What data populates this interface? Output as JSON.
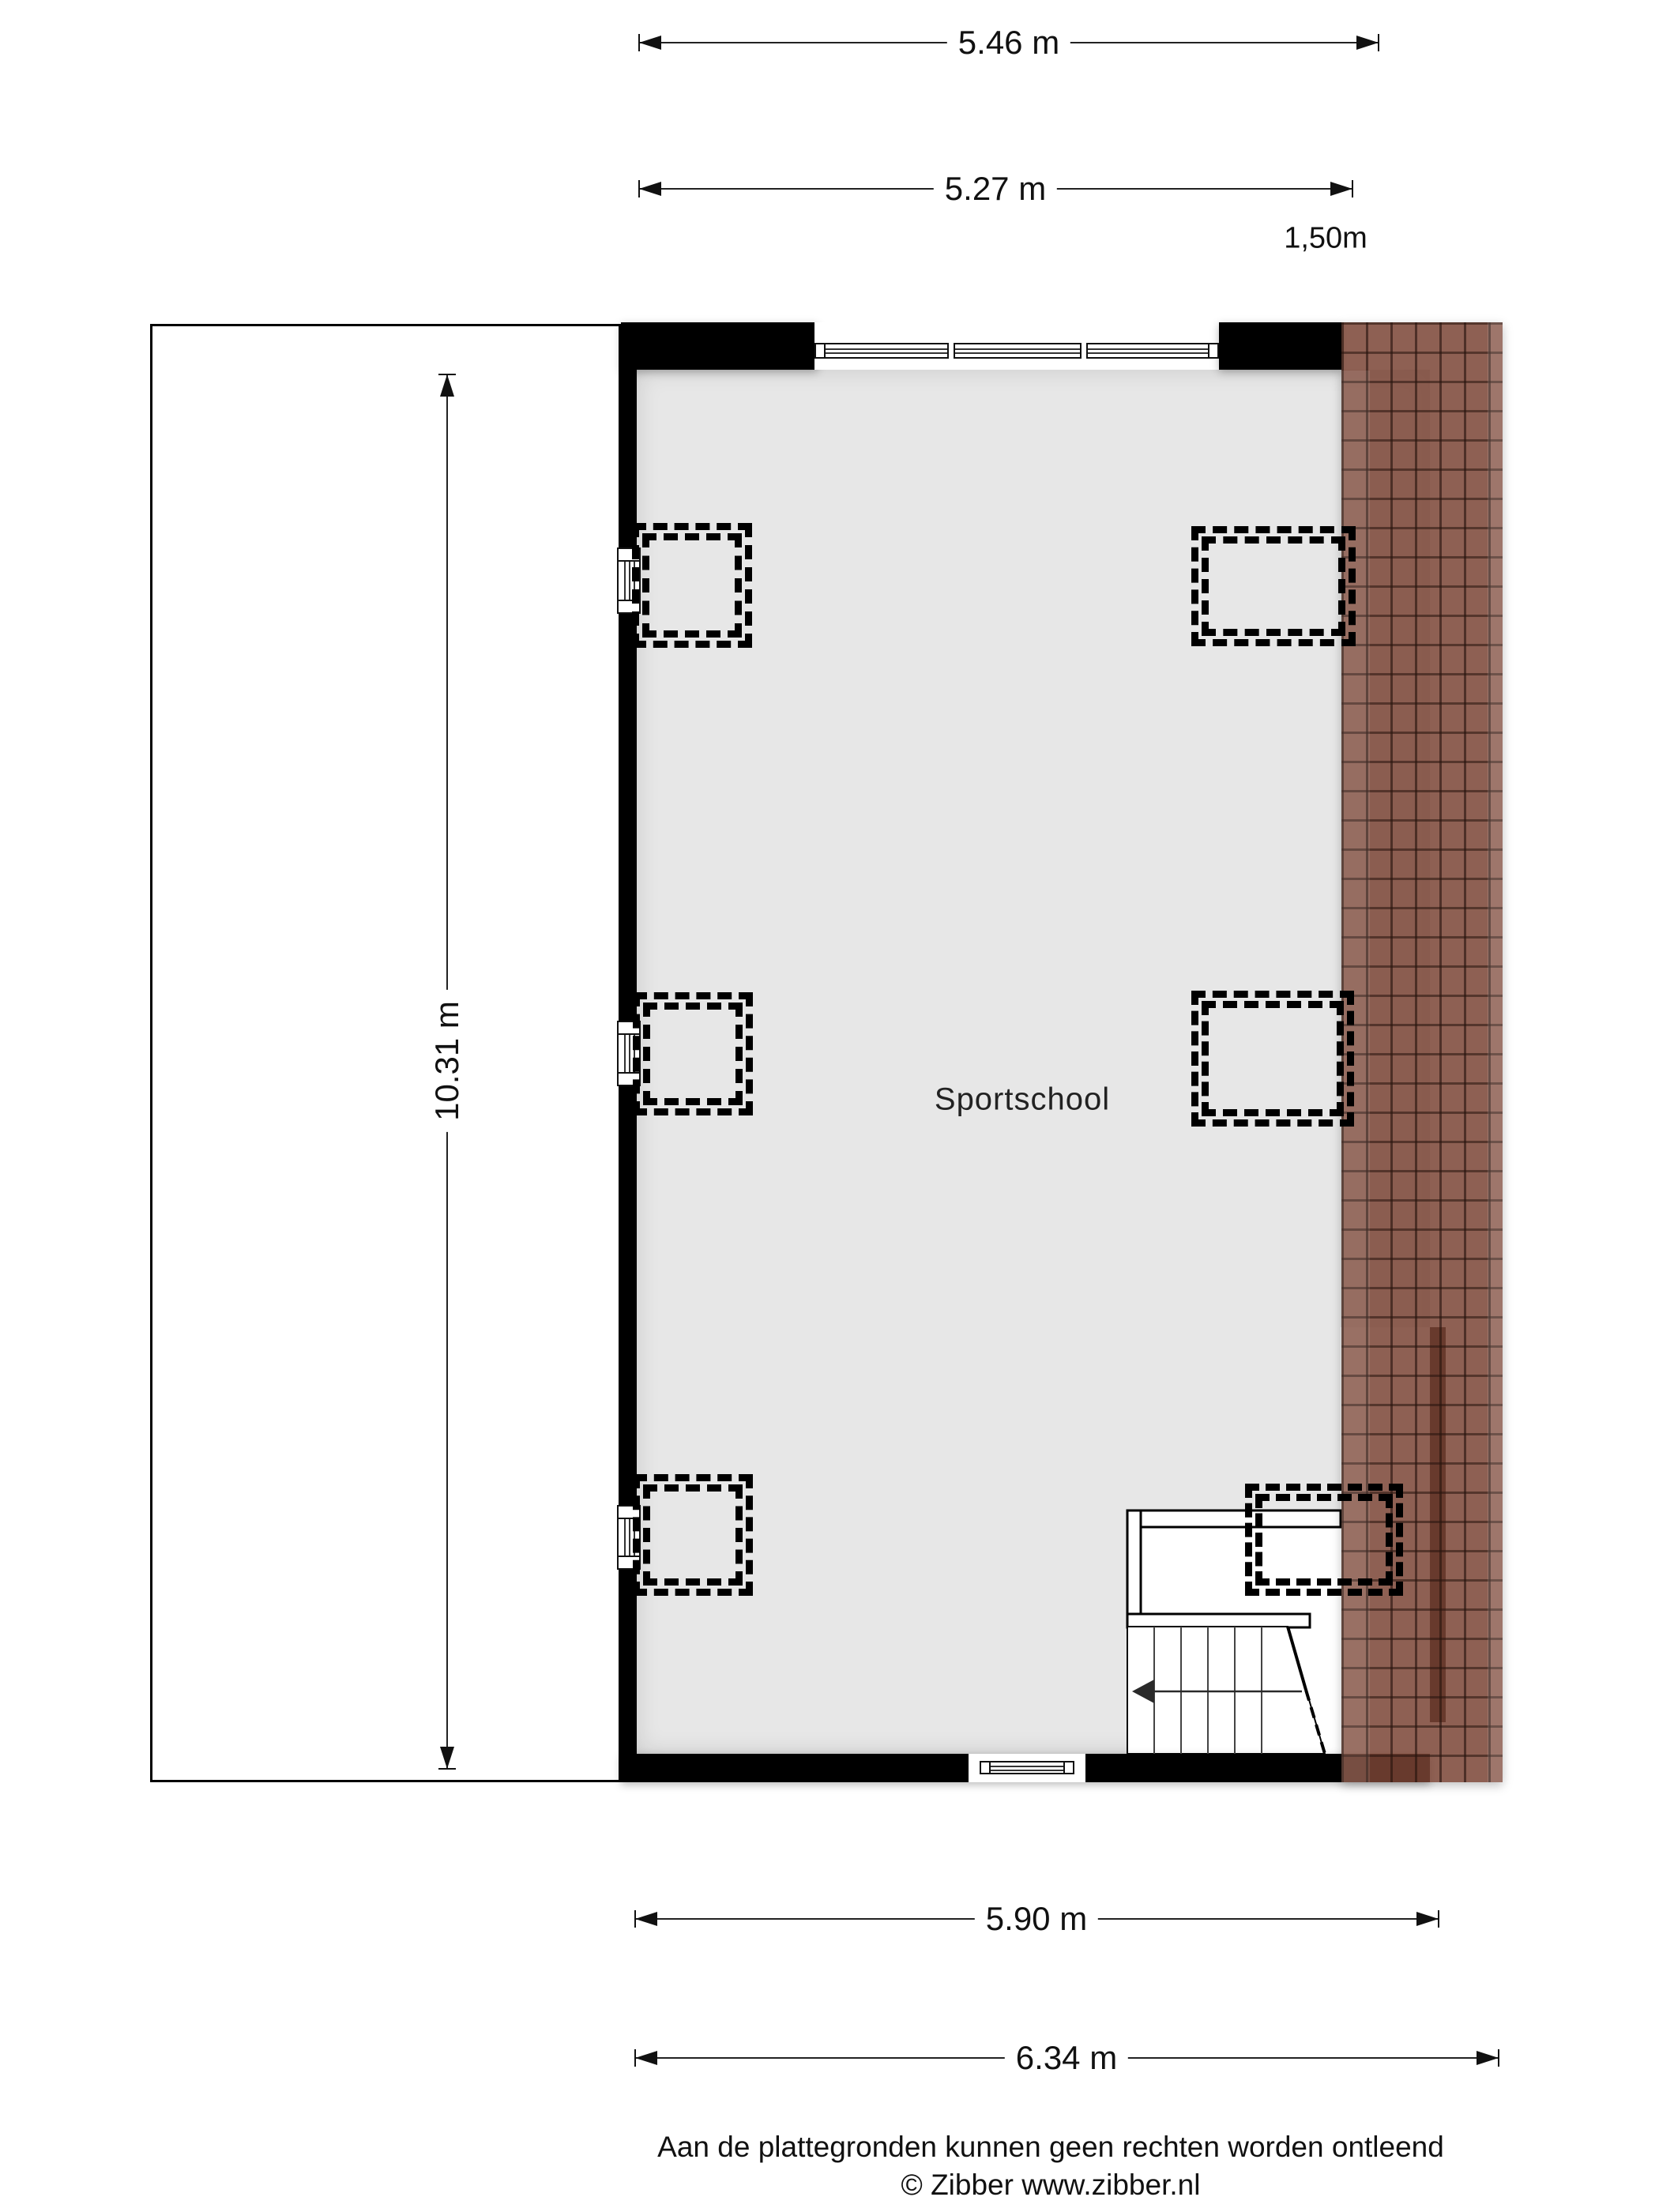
{
  "room": {
    "label": "Sportschool"
  },
  "dimensions": {
    "top_outer": "5.46 m",
    "top_inner": "5.27 m",
    "roof_headroom": "1,50m",
    "left_height": "10.31 m",
    "bottom_inner": "5.90 m",
    "bottom_outer": "6.34 m"
  },
  "footer": {
    "line1": "Aan de plattegronden kunnen geen rechten worden ontleend",
    "line2": "© Zibber www.zibber.nl"
  },
  "colors": {
    "floor_fill": "#e7e7e7",
    "wall_fill": "#000000",
    "roof_tile": "#8a5c50",
    "background": "#ffffff",
    "dimension_text": "#111111"
  }
}
